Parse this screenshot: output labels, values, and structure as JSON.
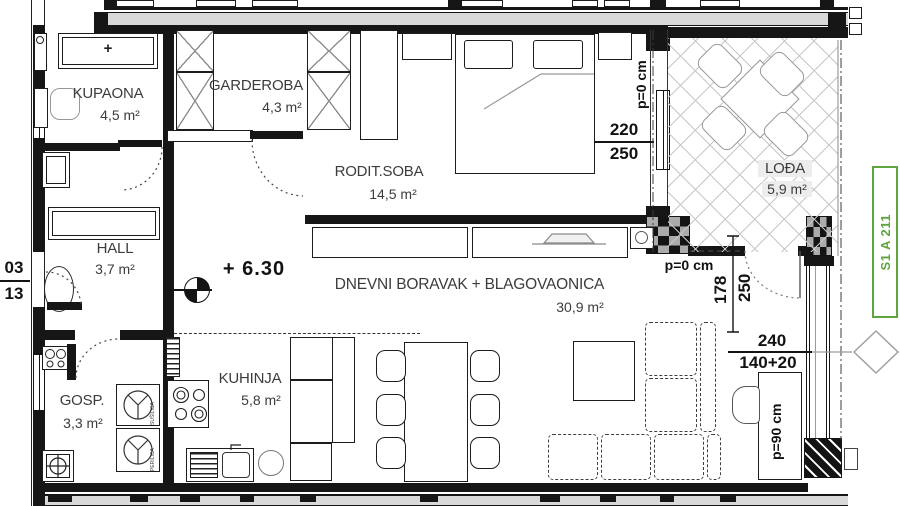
{
  "plan": {
    "unit_label": "S1 A 211",
    "elevation_mark": "+ 6.30",
    "entry": {
      "floor": "03",
      "unit": "13"
    },
    "rooms": {
      "kupaona": {
        "name": "KUPAONA",
        "area": "4,5 m²"
      },
      "garderoba": {
        "name": "GARDEROBA",
        "area": "4,3 m²"
      },
      "rodit_soba": {
        "name": "RODIT.SOBA",
        "area": "14,5 m²"
      },
      "hall": {
        "name": "HALL",
        "area": "3,7 m²"
      },
      "gosp": {
        "name": "GOSP.",
        "area": "3,3 m²"
      },
      "kuhinja": {
        "name": "KUHINJA",
        "area": "5,8 m²"
      },
      "dnevni": {
        "name": "DNEVNI BORAVAK + BLAGOVAONICA",
        "area": "30,9 m²"
      },
      "lodja": {
        "name": "LOĐA",
        "area": "5,9 m²"
      }
    },
    "dimensions": {
      "bedroom_window_width": "220",
      "bedroom_window_height": "250",
      "bedroom_parapet": "p=0 cm",
      "loggia_door_width": "178",
      "loggia_door_height": "250",
      "loggia_door_parapet": "p=0 cm",
      "living_window_width": "240",
      "living_window_height": "140+20",
      "living_parapet": "p=90 cm"
    },
    "appliances": {
      "dryer": "SUŠILICA",
      "washer": "PERILICA"
    },
    "marks": {
      "bath_cabinet": "+"
    },
    "colors": {
      "wall": "#161616",
      "corridor": "#d9d9d9",
      "accent_green": "#5fa53f",
      "hatch": "#c7c7c7"
    }
  }
}
